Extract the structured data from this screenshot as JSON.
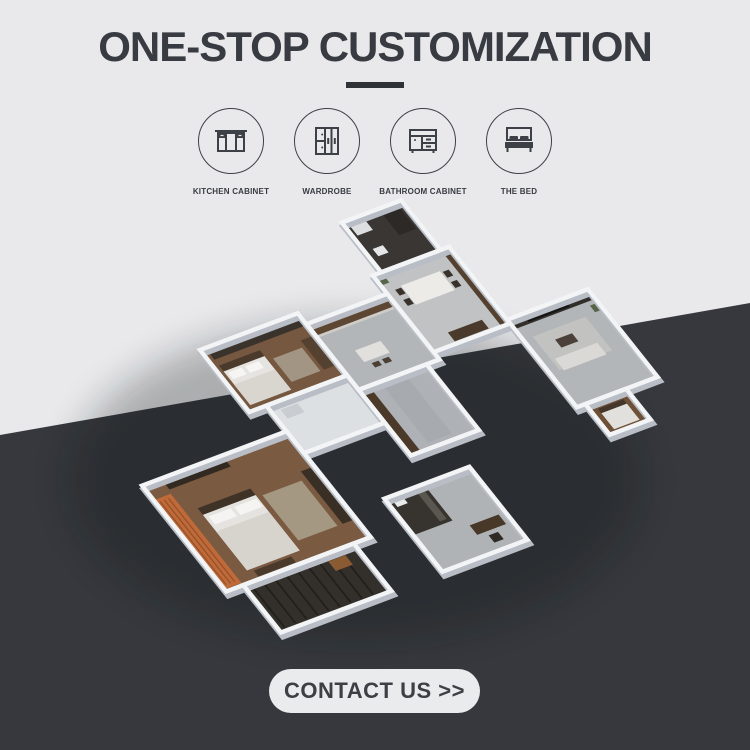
{
  "header": {
    "title": "ONE-STOP CUSTOMIZATION"
  },
  "features": {
    "items": [
      {
        "label": "KITCHEN CABINET",
        "icon": "kitchen-cabinet-icon"
      },
      {
        "label": "WARDROBE",
        "icon": "wardrobe-icon"
      },
      {
        "label": "BATHROOM CABINET",
        "icon": "bathroom-cabinet-icon"
      },
      {
        "label": "THE BED",
        "icon": "the-bed-icon"
      }
    ]
  },
  "hero": {
    "name": "3d-apartment-floor-plan-render"
  },
  "cta": {
    "label": "CONTACT US >>"
  },
  "colors": {
    "background_light": "#e9e9eb",
    "background_dark": "#36383d",
    "text_dark": "#383b41",
    "button_background": "#eaebec",
    "accent_orange": "#c06a39"
  }
}
